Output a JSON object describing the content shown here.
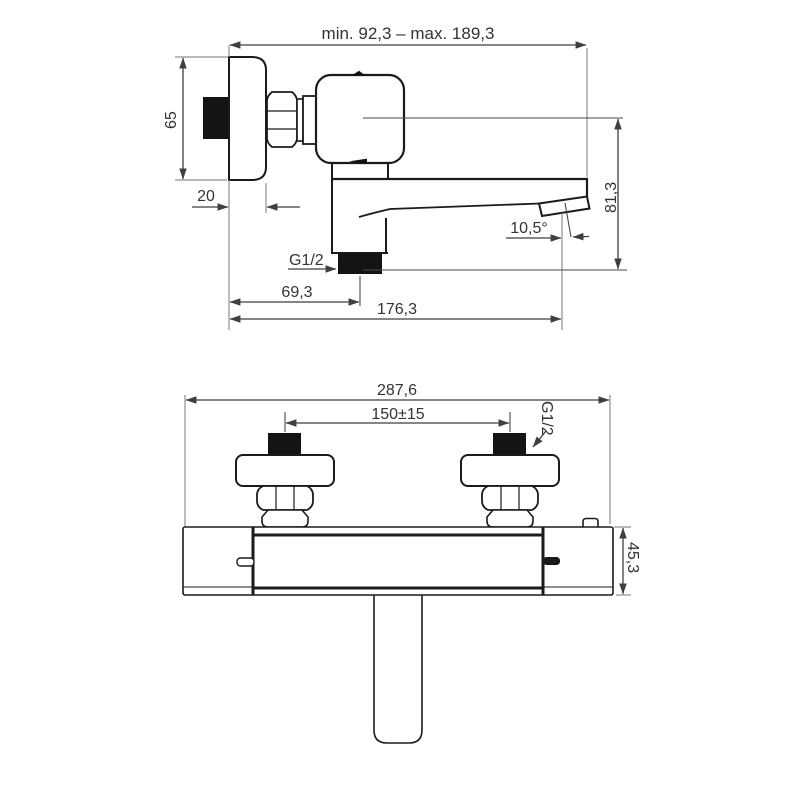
{
  "drawing": {
    "background": "#ffffff",
    "outline_color": "#1b1b1b",
    "dimension_color": "#3f3f3f",
    "extension_color": "#8f8f8f",
    "text_color": "#333333",
    "side_view": {
      "dim_width_range": "min. 92,3 – max. 189,3",
      "dim_flange_height": "65",
      "dim_flange_depth": "20",
      "label_outlet_thread": "G1/2",
      "dim_thread_offset": "69,3",
      "dim_spout_reach": "176,3",
      "dim_spout_angle": "10,5°",
      "dim_outlet_height": "81,3"
    },
    "front_view": {
      "dim_total_width": "287,6",
      "dim_inlet_spacing": "150±15",
      "label_inlet_thread": "G1/2",
      "dim_body_height": "45,3"
    }
  }
}
